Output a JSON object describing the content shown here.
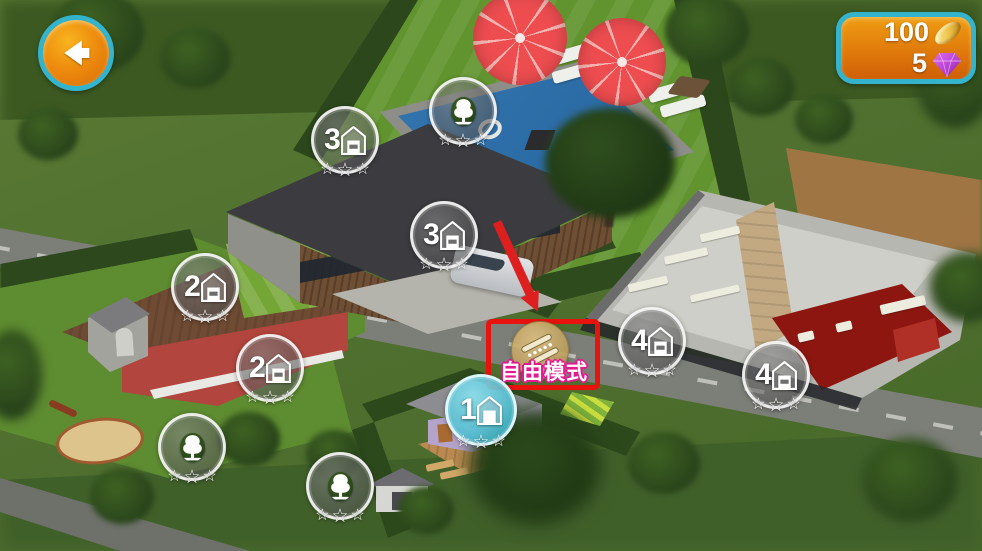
{
  "hud": {
    "back_button": {
      "icon": "back-arrow-icon"
    },
    "currency_panel": {
      "coins": {
        "value": "100",
        "icon": "coin-icon"
      },
      "gems": {
        "value": "5",
        "icon": "gem-icon"
      }
    }
  },
  "free_mode_button": {
    "label": "自由模式",
    "icon": "diagonal-ruler-icon",
    "highlighted": true
  },
  "tutorial": {
    "highlight_shape": "red-rectangle",
    "pointer": "red-arrow"
  },
  "badges": [
    {
      "level": "3",
      "icon": "house",
      "stars_total": 3,
      "stars_filled": 0,
      "state": "normal",
      "x": 345,
      "y": 140
    },
    {
      "level": "3",
      "icon": "tree",
      "stars_total": 3,
      "stars_filled": 0,
      "state": "normal",
      "x": 463,
      "y": 111
    },
    {
      "level": "3",
      "icon": "house",
      "stars_total": 3,
      "stars_filled": 0,
      "state": "normal",
      "x": 444,
      "y": 235
    },
    {
      "level": "2",
      "icon": "house",
      "stars_total": 3,
      "stars_filled": 0,
      "state": "normal",
      "x": 205,
      "y": 287
    },
    {
      "level": "2",
      "icon": "house",
      "stars_total": 3,
      "stars_filled": 0,
      "state": "normal",
      "x": 270,
      "y": 368
    },
    {
      "level": "2",
      "icon": "tree",
      "stars_total": 3,
      "stars_filled": 0,
      "state": "normal",
      "x": 192,
      "y": 447
    },
    {
      "level": "1",
      "icon": "tree",
      "stars_total": 3,
      "stars_filled": 0,
      "state": "normal",
      "x": 340,
      "y": 486
    },
    {
      "level": "1",
      "icon": "house",
      "stars_total": 3,
      "stars_filled": 0,
      "state": "active",
      "x": 481,
      "y": 408
    },
    {
      "level": "4",
      "icon": "house",
      "stars_total": 3,
      "stars_filled": 0,
      "state": "normal",
      "x": 652,
      "y": 341
    },
    {
      "level": "4",
      "icon": "house",
      "stars_total": 3,
      "stars_filled": 0,
      "state": "normal",
      "x": 776,
      "y": 375
    }
  ],
  "icons": {
    "star_glyph": "☆"
  },
  "colors": {
    "hud_border_teal": "#33b4cc",
    "hud_fill_orange": "#e8820d",
    "tutorial_red": "#e8130f",
    "label_outline_magenta": "#e6188e",
    "active_badge_teal": "#3fc0d6",
    "free_mode_gold": "#c9a96a",
    "gem_purple": "#b43ecf",
    "coin_gold": "#e9c04a"
  }
}
